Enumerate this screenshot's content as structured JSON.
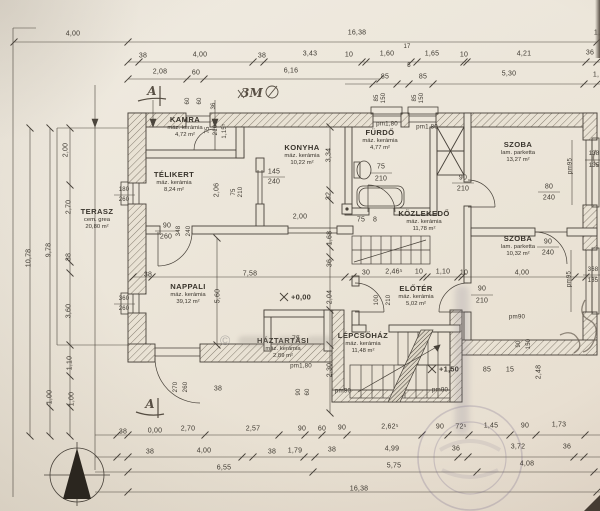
{
  "plan": {
    "paper_color": "#ece6da",
    "line_color": "#474139"
  },
  "watermark": {
    "symbol": "©"
  },
  "rooms": [
    {
      "name": "KAMRA",
      "material": "máz. kerámia",
      "area": "4,72 m²",
      "x": 185,
      "y": 121
    },
    {
      "name": "TÉLIKERT",
      "material": "máz. kerámia",
      "area": "8,24 m²",
      "x": 174,
      "y": 176
    },
    {
      "name": "KONYHA",
      "material": "máz. kerámia",
      "area": "10,22 m²",
      "x": 302,
      "y": 149
    },
    {
      "name": "FÜRDŐ",
      "material": "máz. kerámia",
      "area": "4,77 m²",
      "x": 380,
      "y": 134
    },
    {
      "name": "SZOBA",
      "material": "lam. parketta",
      "area": "13,27 m²",
      "x": 518,
      "y": 146
    },
    {
      "name": "SZOBA",
      "material": "lam. parketta",
      "area": "10,32 m²",
      "x": 518,
      "y": 240
    },
    {
      "name": "KÖZLEKEDŐ",
      "material": "máz. kerámia",
      "area": "11,78 m²",
      "x": 424,
      "y": 215
    },
    {
      "name": "TERASZ",
      "material": "cem. grea",
      "area": "20,80 m²",
      "x": 97,
      "y": 213
    },
    {
      "name": "NAPPALI",
      "material": "máz. kerámia",
      "area": "39,12 m²",
      "x": 188,
      "y": 288
    },
    {
      "name": "HÁZTARTÁSI",
      "material": "máz. kerámia",
      "area": "2,89 m²",
      "x": 283,
      "y": 342
    },
    {
      "name": "LÉPCSŐHÁZ",
      "material": "máz. kerámia",
      "area": "11,48 m²",
      "x": 363,
      "y": 337
    },
    {
      "name": "ELŐTÉR",
      "material": "máz. kerámia",
      "area": "5,02 m²",
      "x": 416,
      "y": 290
    }
  ],
  "labels": [
    {
      "text": "4,00",
      "x": 73,
      "y": 34
    },
    {
      "text": "16,38",
      "x": 357,
      "y": 33
    },
    {
      "text": "1,",
      "x": 597,
      "y": 33
    },
    {
      "text": "38",
      "x": 143,
      "y": 56
    },
    {
      "text": "4,00",
      "x": 200,
      "y": 55
    },
    {
      "text": "38",
      "x": 262,
      "y": 56
    },
    {
      "text": "3,43",
      "x": 310,
      "y": 54
    },
    {
      "text": "10",
      "x": 349,
      "y": 55
    },
    {
      "text": "1,60",
      "x": 387,
      "y": 54
    },
    {
      "text": "17",
      "x": 407,
      "y": 47,
      "size": 6
    },
    {
      "text": "5",
      "x": 409,
      "y": 66,
      "size": 6
    },
    {
      "text": "1,65",
      "x": 432,
      "y": 54
    },
    {
      "text": "10",
      "x": 464,
      "y": 55
    },
    {
      "text": "4,21",
      "x": 524,
      "y": 54
    },
    {
      "text": "36",
      "x": 590,
      "y": 53
    },
    {
      "text": "2,08",
      "x": 160,
      "y": 72
    },
    {
      "text": "60",
      "x": 196,
      "y": 73
    },
    {
      "text": "6,16",
      "x": 291,
      "y": 71
    },
    {
      "text": "85",
      "x": 385,
      "y": 77
    },
    {
      "text": "85",
      "x": 423,
      "y": 77
    },
    {
      "text": "5,30",
      "x": 509,
      "y": 74
    },
    {
      "text": "1,",
      "x": 596,
      "y": 75
    },
    {
      "text": "85",
      "x": 377,
      "y": 98,
      "rot": -90,
      "size": 6
    },
    {
      "text": "150",
      "x": 384,
      "y": 98,
      "rot": -90,
      "size": 6
    },
    {
      "text": "85",
      "x": 415,
      "y": 98,
      "rot": -90,
      "size": 6
    },
    {
      "text": "150",
      "x": 422,
      "y": 98,
      "rot": -90,
      "size": 6
    },
    {
      "text": "60",
      "x": 188,
      "y": 101,
      "rot": -90,
      "size": 6
    },
    {
      "text": "60",
      "x": 200,
      "y": 101,
      "rot": -90,
      "size": 6
    },
    {
      "text": "36",
      "x": 214,
      "y": 106,
      "rot": -90,
      "size": 6
    },
    {
      "text": "75",
      "x": 208,
      "y": 130,
      "rot": -90,
      "size": 6
    },
    {
      "text": "210",
      "x": 216,
      "y": 130,
      "rot": -90,
      "size": 6
    },
    {
      "text": "1,15⁵",
      "x": 225,
      "y": 131,
      "rot": -90,
      "size": 6
    },
    {
      "text": "pm1,80",
      "x": 387,
      "y": 124,
      "kind": "pm"
    },
    {
      "text": "pm1,80",
      "x": 427,
      "y": 127,
      "kind": "pm"
    },
    {
      "text": "75",
      "x": 381,
      "y": 167
    },
    {
      "text": "210",
      "x": 381,
      "y": 179
    },
    {
      "text": "75",
      "x": 361,
      "y": 220
    },
    {
      "text": "8",
      "x": 375,
      "y": 220
    },
    {
      "text": "145",
      "x": 274,
      "y": 172
    },
    {
      "text": "240",
      "x": 274,
      "y": 182
    },
    {
      "text": "2,00",
      "x": 300,
      "y": 217
    },
    {
      "text": "75",
      "x": 234,
      "y": 192,
      "rot": -90,
      "size": 6
    },
    {
      "text": "210",
      "x": 241,
      "y": 192,
      "rot": -90,
      "size": 6
    },
    {
      "text": "2,06",
      "x": 217,
      "y": 190,
      "rot": -90
    },
    {
      "text": "3,34",
      "x": 329,
      "y": 155,
      "rot": -90
    },
    {
      "text": "32",
      "x": 329,
      "y": 196,
      "rot": -90
    },
    {
      "text": "1,68",
      "x": 330,
      "y": 238,
      "rot": -90
    },
    {
      "text": "36",
      "x": 330,
      "y": 263,
      "rot": -90
    },
    {
      "text": "2,04",
      "x": 330,
      "y": 297,
      "rot": -90
    },
    {
      "text": "2,30",
      "x": 330,
      "y": 370,
      "rot": -90
    },
    {
      "text": "5,60",
      "x": 218,
      "y": 296,
      "rot": -90
    },
    {
      "text": "38",
      "x": 148,
      "y": 275
    },
    {
      "text": "7,58",
      "x": 250,
      "y": 274
    },
    {
      "text": "30",
      "x": 366,
      "y": 273
    },
    {
      "text": "2,46⁵",
      "x": 394,
      "y": 272
    },
    {
      "text": "10",
      "x": 419,
      "y": 272
    },
    {
      "text": "1,10",
      "x": 443,
      "y": 272
    },
    {
      "text": "10",
      "x": 464,
      "y": 273
    },
    {
      "text": "4,00",
      "x": 522,
      "y": 273
    },
    {
      "text": "90",
      "x": 463,
      "y": 178
    },
    {
      "text": "210",
      "x": 463,
      "y": 189
    },
    {
      "text": "80",
      "x": 549,
      "y": 187
    },
    {
      "text": "240",
      "x": 549,
      "y": 198
    },
    {
      "text": "90",
      "x": 548,
      "y": 242
    },
    {
      "text": "240",
      "x": 548,
      "y": 253
    },
    {
      "text": "pm95",
      "x": 570,
      "y": 166,
      "rot": -90,
      "kind": "pm"
    },
    {
      "text": "pm95",
      "x": 569,
      "y": 279,
      "rot": -90,
      "kind": "pm"
    },
    {
      "text": "138",
      "x": 594,
      "y": 154,
      "size": 6
    },
    {
      "text": "135",
      "x": 594,
      "y": 166,
      "size": 6
    },
    {
      "text": "368",
      "x": 593,
      "y": 270,
      "size": 6
    },
    {
      "text": "135",
      "x": 593,
      "y": 281,
      "size": 6
    },
    {
      "text": "90",
      "x": 482,
      "y": 289
    },
    {
      "text": "210",
      "x": 482,
      "y": 301
    },
    {
      "text": "100",
      "x": 377,
      "y": 300,
      "rot": -90,
      "size": 6
    },
    {
      "text": "210",
      "x": 389,
      "y": 300,
      "rot": -90,
      "size": 6
    },
    {
      "text": "180",
      "x": 124,
      "y": 190,
      "size": 6
    },
    {
      "text": "260",
      "x": 124,
      "y": 200,
      "size": 6
    },
    {
      "text": "360",
      "x": 124,
      "y": 299,
      "size": 6
    },
    {
      "text": "260",
      "x": 124,
      "y": 309,
      "size": 6
    },
    {
      "text": "90",
      "x": 167,
      "y": 226
    },
    {
      "text": "260",
      "x": 166,
      "y": 237
    },
    {
      "text": "348",
      "x": 179,
      "y": 231,
      "rot": -90,
      "size": 6
    },
    {
      "text": "240",
      "x": 189,
      "y": 231,
      "rot": -90,
      "size": 6
    },
    {
      "text": "270",
      "x": 176,
      "y": 387,
      "rot": -90,
      "size": 6
    },
    {
      "text": "260",
      "x": 186,
      "y": 387,
      "rot": -90,
      "size": 6
    },
    {
      "text": "38",
      "x": 218,
      "y": 389
    },
    {
      "text": "75",
      "x": 296,
      "y": 339
    },
    {
      "text": "pm1,80",
      "x": 301,
      "y": 366,
      "kind": "pm"
    },
    {
      "text": "90",
      "x": 299,
      "y": 392,
      "rot": -90,
      "size": 6
    },
    {
      "text": "60",
      "x": 308,
      "y": 392,
      "rot": -90,
      "size": 6
    },
    {
      "text": "pm90",
      "x": 343,
      "y": 391,
      "kind": "pm"
    },
    {
      "text": "pm90",
      "x": 440,
      "y": 390,
      "kind": "pm"
    },
    {
      "text": "pm90",
      "x": 517,
      "y": 317,
      "kind": "pm"
    },
    {
      "text": "85",
      "x": 487,
      "y": 370
    },
    {
      "text": "15",
      "x": 510,
      "y": 370
    },
    {
      "text": "90",
      "x": 519,
      "y": 344,
      "rot": -90,
      "size": 6
    },
    {
      "text": "150",
      "x": 529,
      "y": 344,
      "rot": -90,
      "size": 6
    },
    {
      "text": "2,48",
      "x": 539,
      "y": 372,
      "rot": -90
    },
    {
      "text": "+0,00",
      "x": 301,
      "y": 297,
      "kind": "level"
    },
    {
      "text": "+1,50",
      "x": 449,
      "y": 369,
      "kind": "level"
    },
    {
      "text": "2,00",
      "x": 66,
      "y": 150,
      "rot": -90
    },
    {
      "text": "2,70",
      "x": 69,
      "y": 207,
      "rot": -90
    },
    {
      "text": "38",
      "x": 69,
      "y": 257,
      "rot": -90
    },
    {
      "text": "9,78",
      "x": 49,
      "y": 250,
      "rot": -90
    },
    {
      "text": "10,78",
      "x": 29,
      "y": 258,
      "rot": -90
    },
    {
      "text": "3,60",
      "x": 69,
      "y": 311,
      "rot": -90
    },
    {
      "text": "1,10",
      "x": 70,
      "y": 363,
      "rot": -90
    },
    {
      "text": "1,00",
      "x": 50,
      "y": 397,
      "rot": -90
    },
    {
      "text": "1,00",
      "x": 72,
      "y": 399,
      "rot": -90
    },
    {
      "text": "38",
      "x": 123,
      "y": 432
    },
    {
      "text": "0,00",
      "x": 155,
      "y": 431
    },
    {
      "text": "2,70",
      "x": 188,
      "y": 429
    },
    {
      "text": "2,57",
      "x": 253,
      "y": 429
    },
    {
      "text": "90",
      "x": 302,
      "y": 429
    },
    {
      "text": "60",
      "x": 322,
      "y": 429
    },
    {
      "text": "90",
      "x": 342,
      "y": 428
    },
    {
      "text": "2,62⁵",
      "x": 390,
      "y": 427
    },
    {
      "text": "90",
      "x": 440,
      "y": 427
    },
    {
      "text": "72⁵",
      "x": 461,
      "y": 427
    },
    {
      "text": "1,45",
      "x": 491,
      "y": 426
    },
    {
      "text": "90",
      "x": 525,
      "y": 426
    },
    {
      "text": "1,73",
      "x": 559,
      "y": 425
    },
    {
      "text": "38",
      "x": 150,
      "y": 452
    },
    {
      "text": "4,00",
      "x": 204,
      "y": 451
    },
    {
      "text": "38",
      "x": 272,
      "y": 452
    },
    {
      "text": "1,79",
      "x": 295,
      "y": 451
    },
    {
      "text": "38",
      "x": 332,
      "y": 450
    },
    {
      "text": "4,99",
      "x": 392,
      "y": 449
    },
    {
      "text": "36",
      "x": 456,
      "y": 449
    },
    {
      "text": "3,72",
      "x": 518,
      "y": 447
    },
    {
      "text": "36",
      "x": 567,
      "y": 447
    },
    {
      "text": "6,55",
      "x": 224,
      "y": 468
    },
    {
      "text": "5,75",
      "x": 394,
      "y": 466
    },
    {
      "text": "4,08",
      "x": 527,
      "y": 464
    },
    {
      "text": "16,38",
      "x": 359,
      "y": 489
    },
    {
      "text": "A",
      "x": 152,
      "y": 91,
      "kind": "anno"
    },
    {
      "text": "A",
      "x": 150,
      "y": 404,
      "kind": "anno"
    },
    {
      "text": "3M",
      "x": 252,
      "y": 93,
      "kind": "anno"
    }
  ]
}
